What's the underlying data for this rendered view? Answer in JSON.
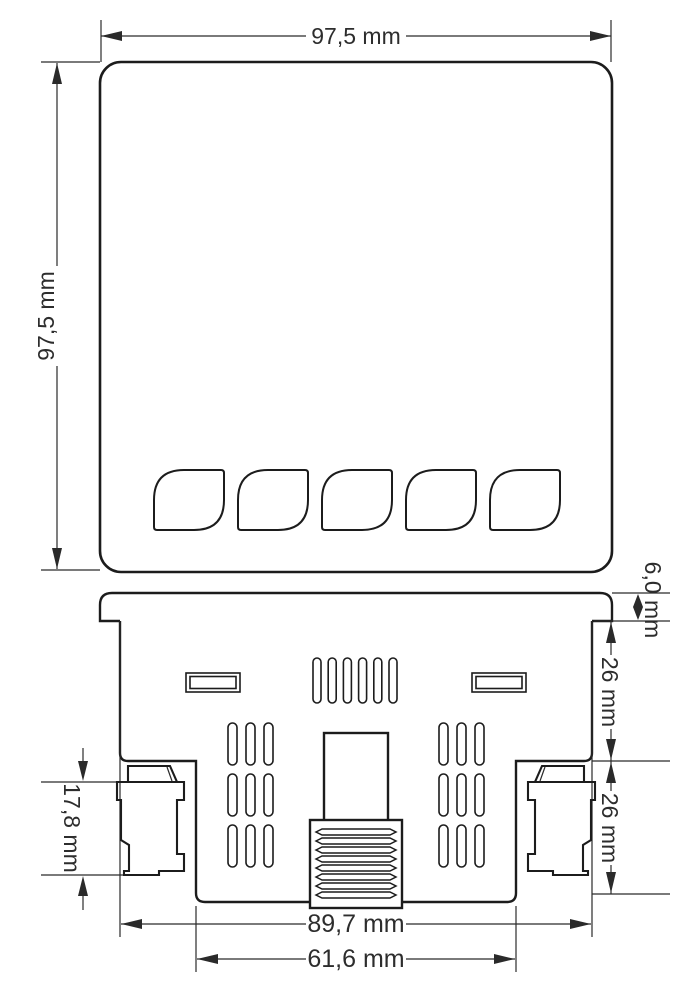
{
  "drawing": {
    "type": "technical-dimension-drawing",
    "subject": "panel meter housing, front view and rear view",
    "colors": {
      "background": "#ffffff",
      "line": "#1c1c1c",
      "dimension_text": "#2d2d2d"
    },
    "front_view": {
      "name": "front view",
      "button_count": 5,
      "width_label": "97,5 mm",
      "height_label": "97,5 mm"
    },
    "rear_view": {
      "name": "rear view",
      "bezel_depth_label": "6,0 mm",
      "depth_upper_label": "26 mm",
      "depth_lower_label": "26 mm",
      "clip_height_label": "17,8 mm",
      "case_width_label": "89,7 mm",
      "terminal_width_label": "61,6 mm"
    }
  }
}
